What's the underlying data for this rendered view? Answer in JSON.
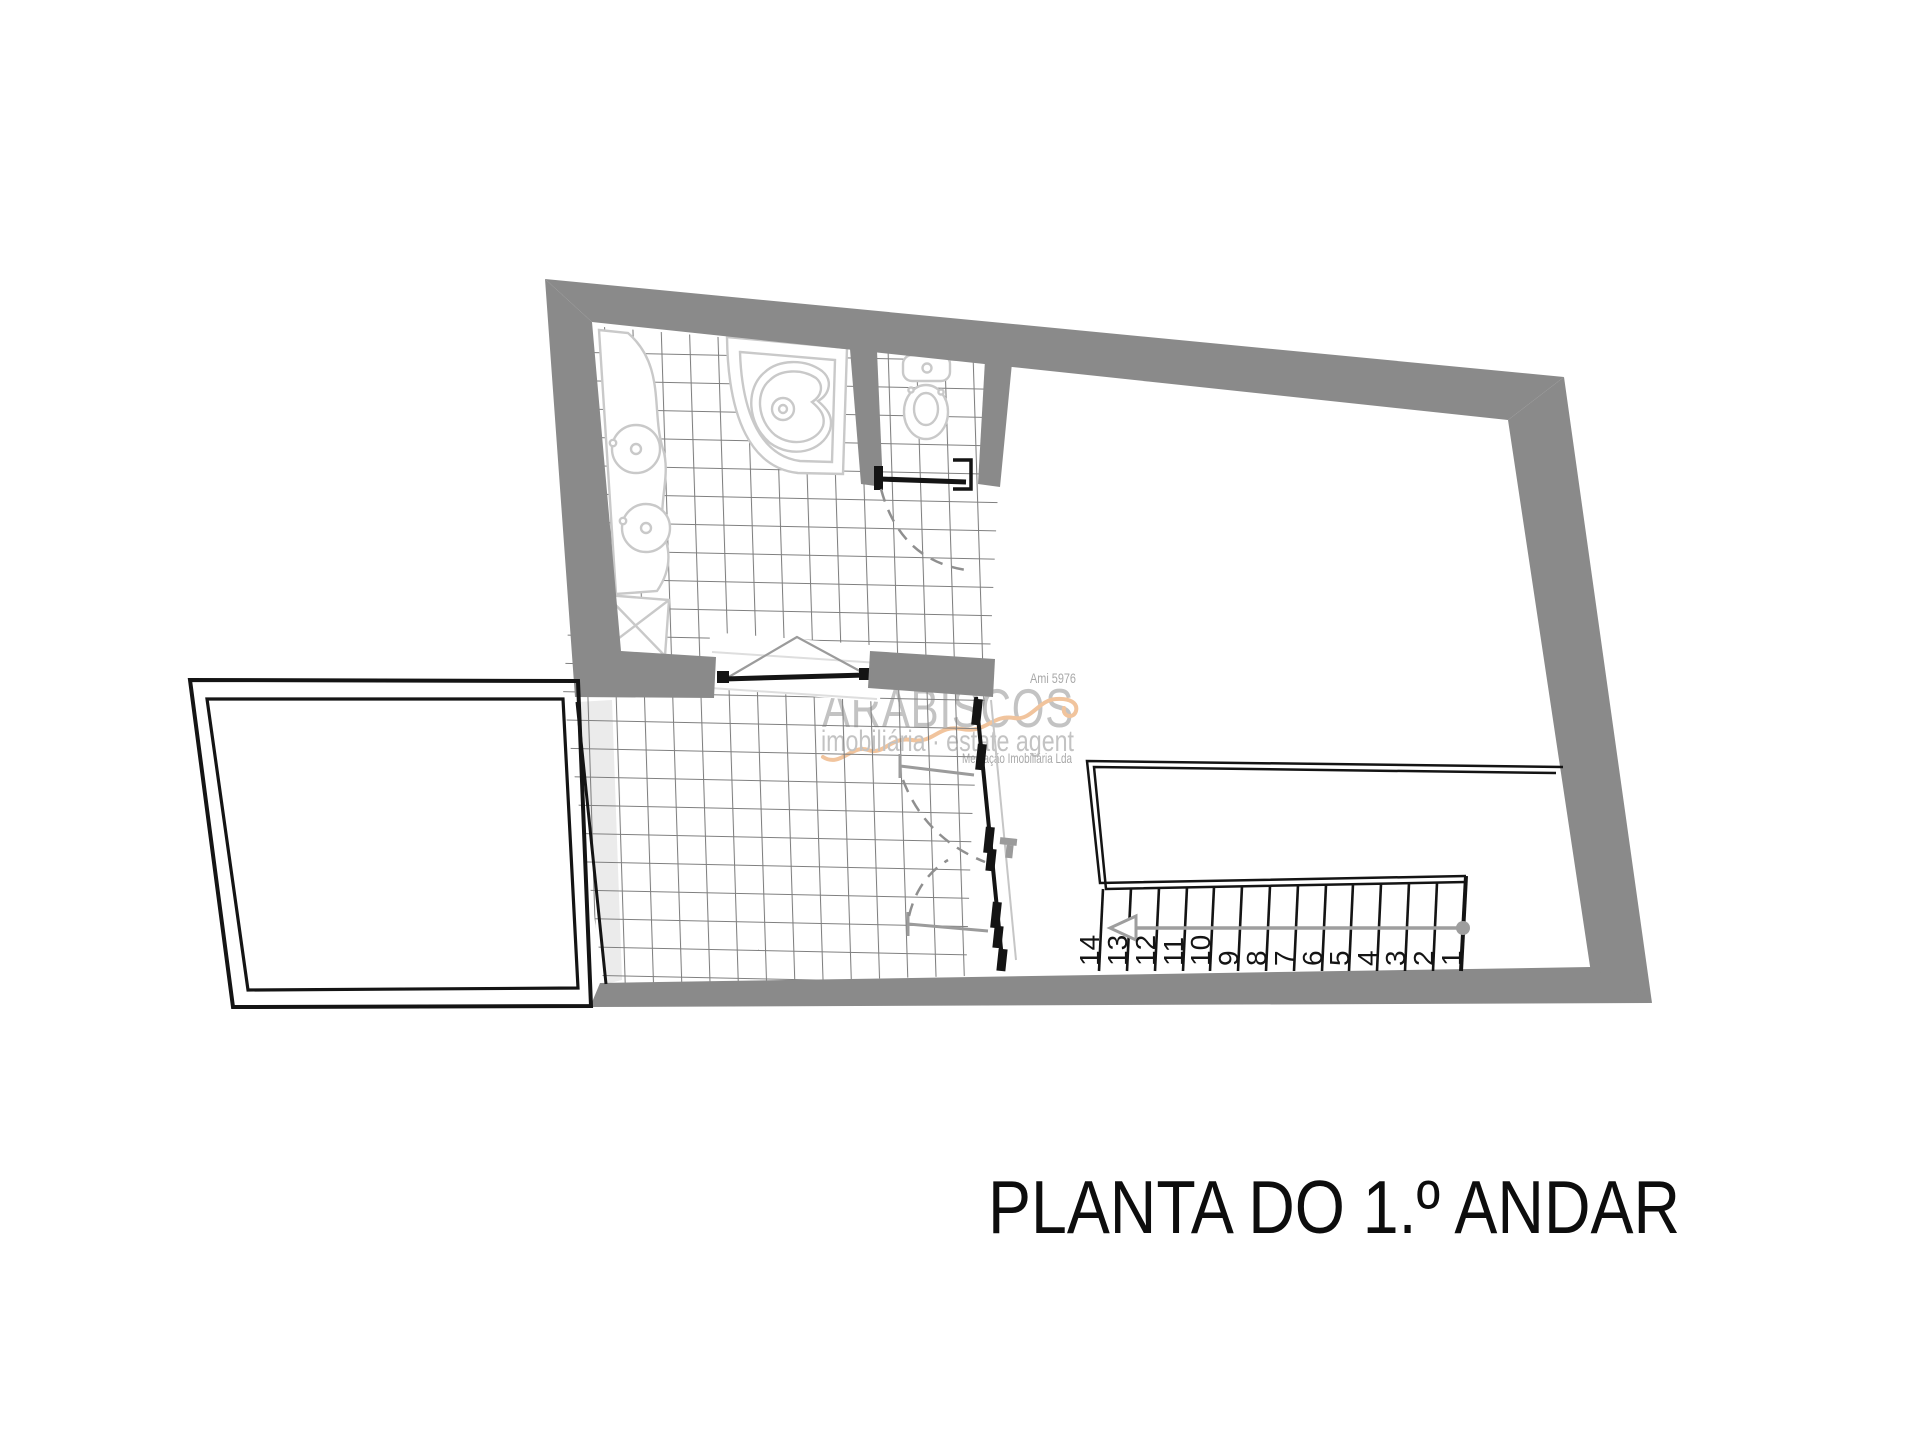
{
  "title": "PLANTA DO 1.º ANDAR",
  "watermark": {
    "license": "Ami 5976",
    "brand": "ARABISCOS",
    "tagline": "imobiliária · estate agent",
    "company": "Mediação Imobiliária Lda"
  },
  "stairs": {
    "display": [
      "14",
      "13",
      "12",
      "11",
      "10",
      "9",
      "8",
      "7",
      "6",
      "5",
      "4",
      "3",
      "2",
      "1"
    ],
    "step_count": 14
  },
  "rooms": {
    "bathroom_fixtures": [
      "bathtub",
      "washbasin",
      "washbasin",
      "shower-tray",
      "toilet"
    ]
  },
  "colors": {
    "wall": "#8a8a8a",
    "tile_line": "#7f7f7f",
    "tile_strip": "#ebebeb",
    "fixture": "#c9c9c9",
    "linework": "#141414",
    "swing": "#8f8f8f",
    "leaf": "#9b9b9b",
    "glass": "#c6c6c6",
    "rail": "#9e9e9e",
    "window_tri": "#9b9b9b",
    "watermark_gray": "#c3c3c3",
    "watermark_small": "#a9a9a9",
    "watermark_orange": "#f1c49d",
    "title": "#0d0d0d",
    "background": "#ffffff"
  }
}
